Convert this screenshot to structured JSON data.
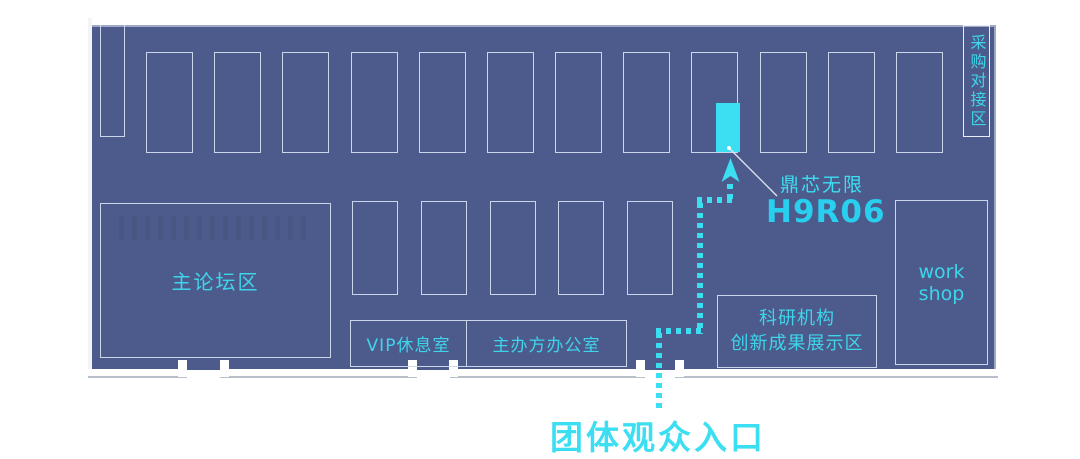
{
  "palette": {
    "background": "#ffffff",
    "floor": "#4d5b8c",
    "outline": "#ccd6ea",
    "outline_bright": "#e9eef8",
    "wall": "#ffffff",
    "wall_shadow": "#b9bfc9",
    "accent": "#3cdff2",
    "label": "#3ed5ea",
    "booth_number": "#29cfee",
    "hatch": "#45527d"
  },
  "map": {
    "areas": {
      "procurement": "采购对接区",
      "main_forum": "主论坛区",
      "vip_lounge": "VIP休息室",
      "organizer_office": "主办方办公室",
      "research_line1": "科研机构",
      "research_line2": "创新成果展示区",
      "workshop": "work shop"
    },
    "highlight": {
      "booth_name": "鼎芯无限",
      "booth_number": "H9R06"
    },
    "entrance": {
      "label": "团体观众入口"
    },
    "booth_counts": {
      "top_row": 12,
      "middle_row": 5
    }
  }
}
